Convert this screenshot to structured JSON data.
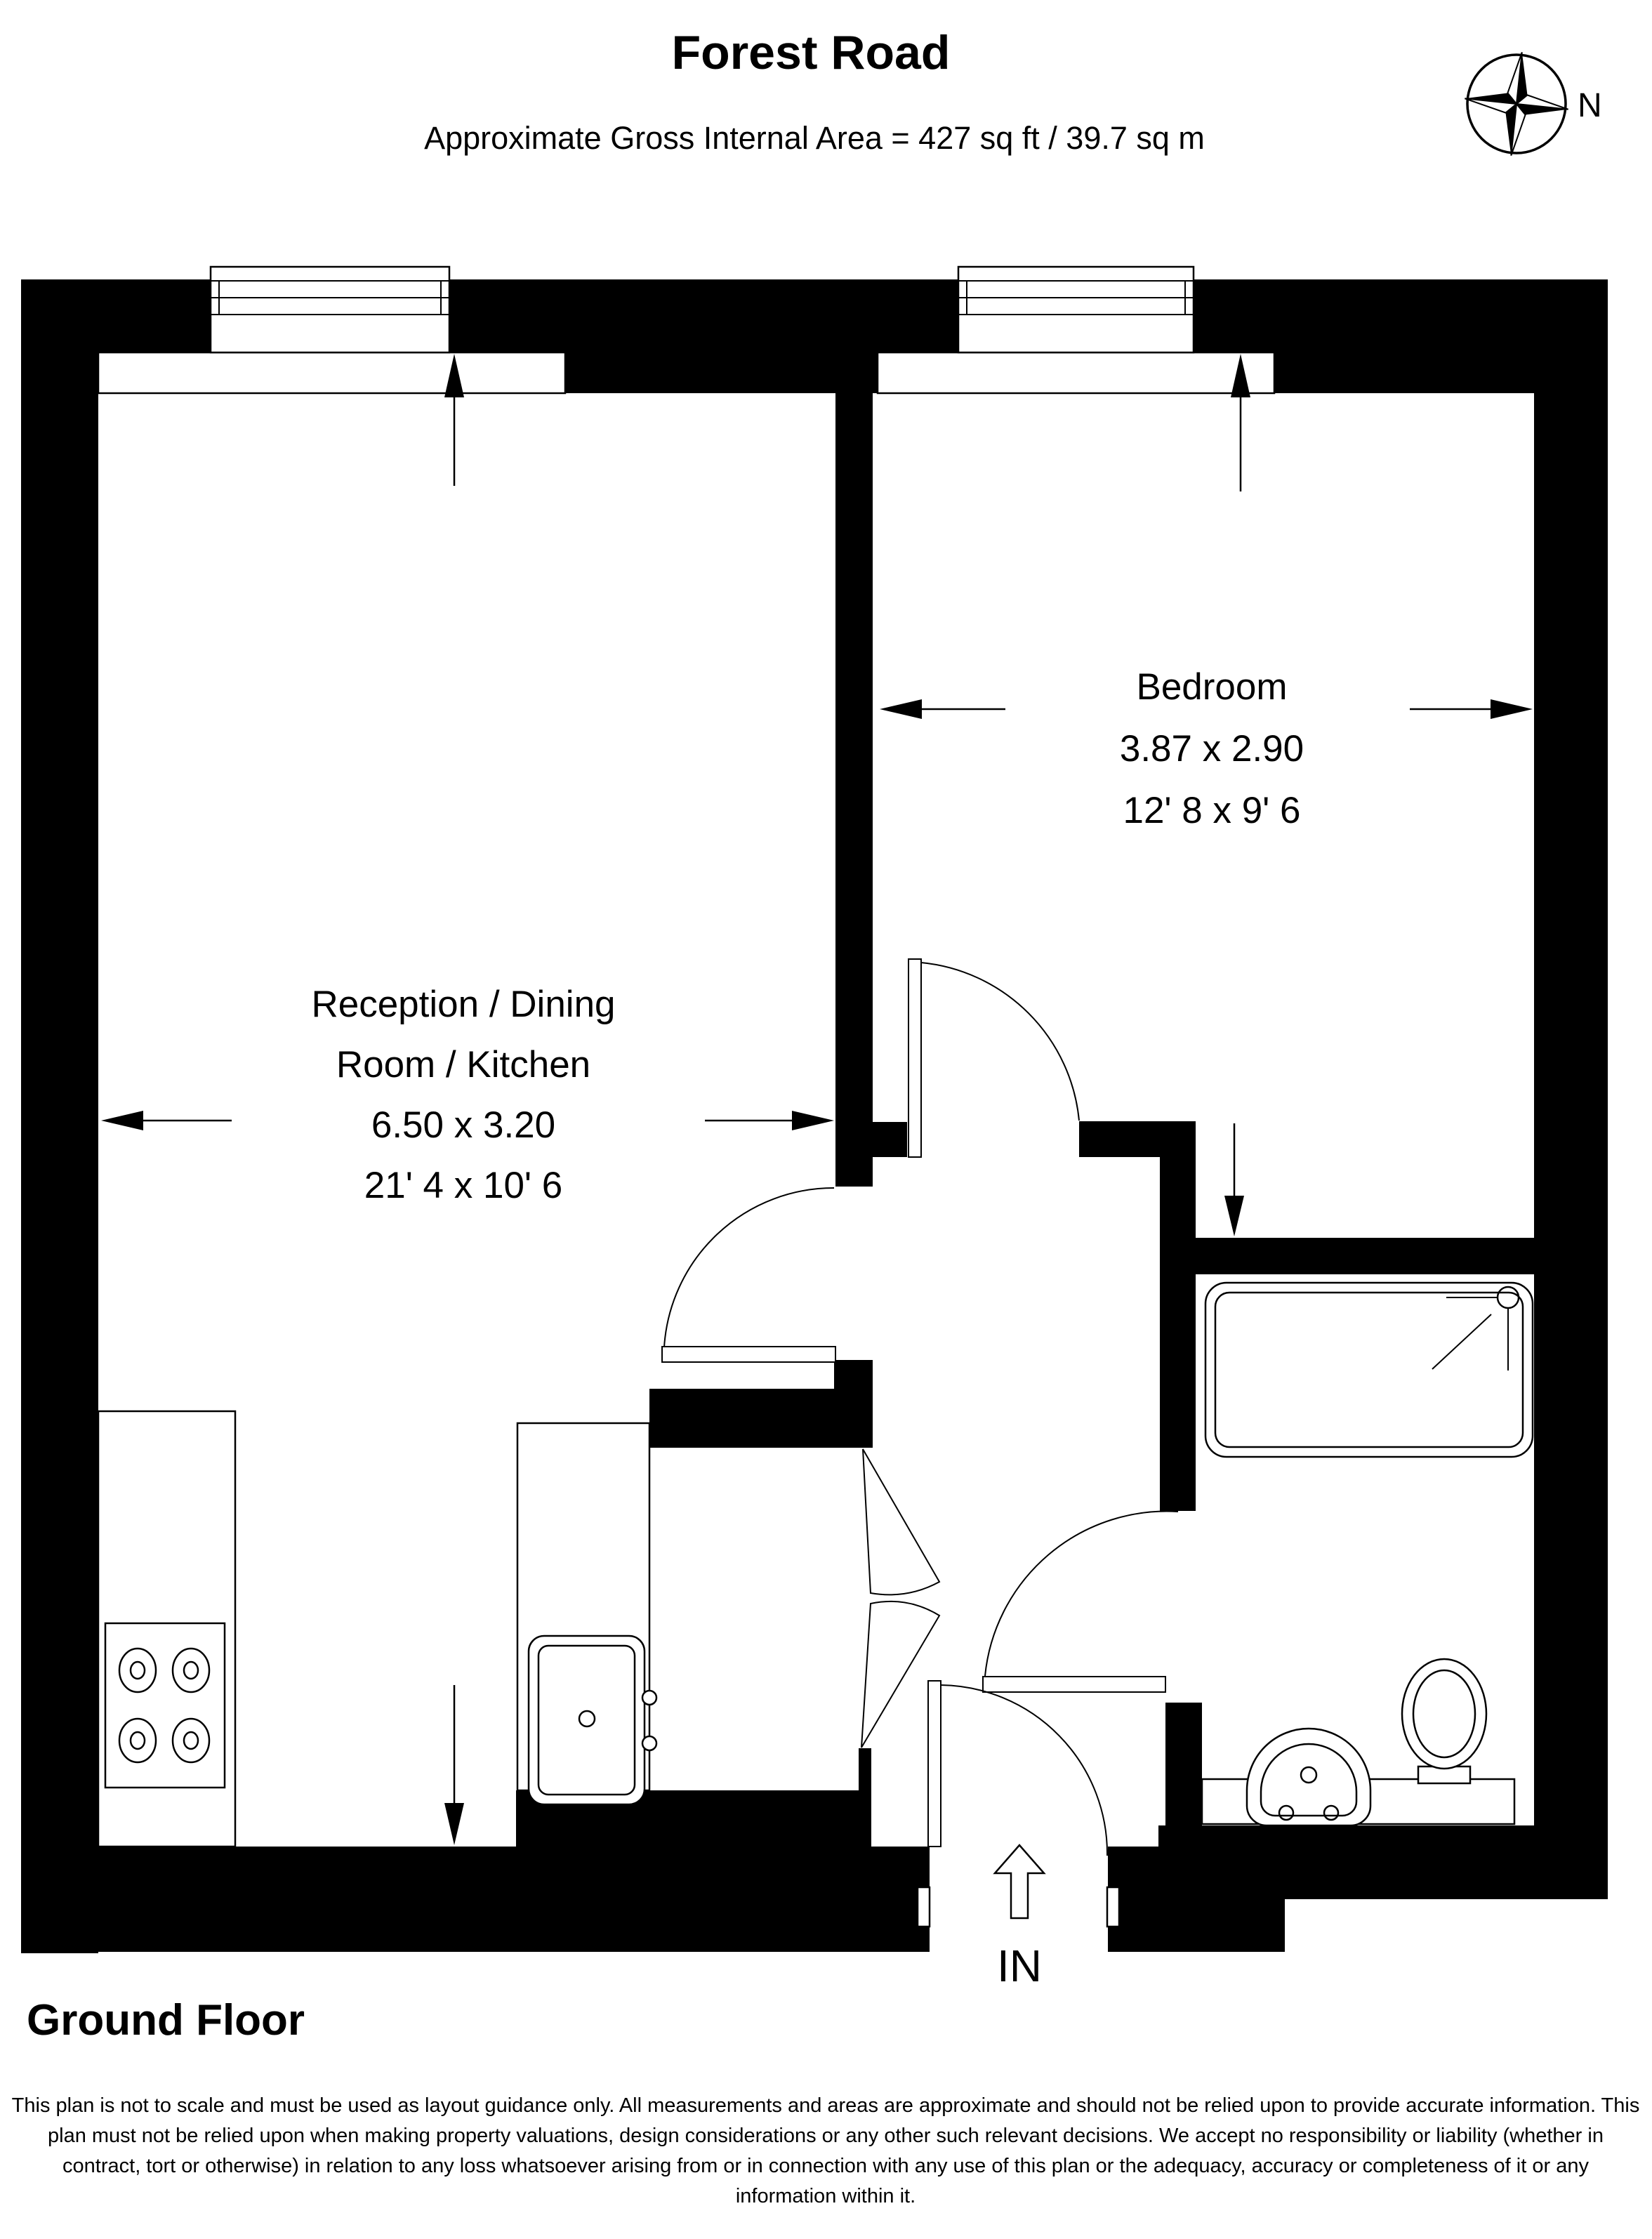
{
  "header": {
    "title": "Forest Road",
    "subtitle": "Approximate Gross Internal Area = 427 sq ft / 39.7 sq m"
  },
  "compass": {
    "label": "N"
  },
  "rooms": {
    "bedroom": {
      "name": "Bedroom",
      "dims_metric": "3.87 x 2.90",
      "dims_imperial": "12' 8 x 9' 6"
    },
    "reception": {
      "name_line1": "Reception / Dining",
      "name_line2": "Room / Kitchen",
      "dims_metric": "6.50 x 3.20",
      "dims_imperial": "21' 4 x 10' 6"
    }
  },
  "entrance": {
    "label": "IN"
  },
  "floor": {
    "label": "Ground Floor"
  },
  "disclaimer": "This plan is not to scale and must be used as layout guidance only. All measurements and areas are approximate and should not be relied upon to provide accurate information. This plan must not be relied upon when making property valuations, design considerations or any other such relevant decisions. We accept no responsibility or liability (whether in contract, tort or otherwise) in relation to any loss whatsoever arising from or in connection with any use of this plan or the adequacy, accuracy or completeness of it or any information within it."
}
